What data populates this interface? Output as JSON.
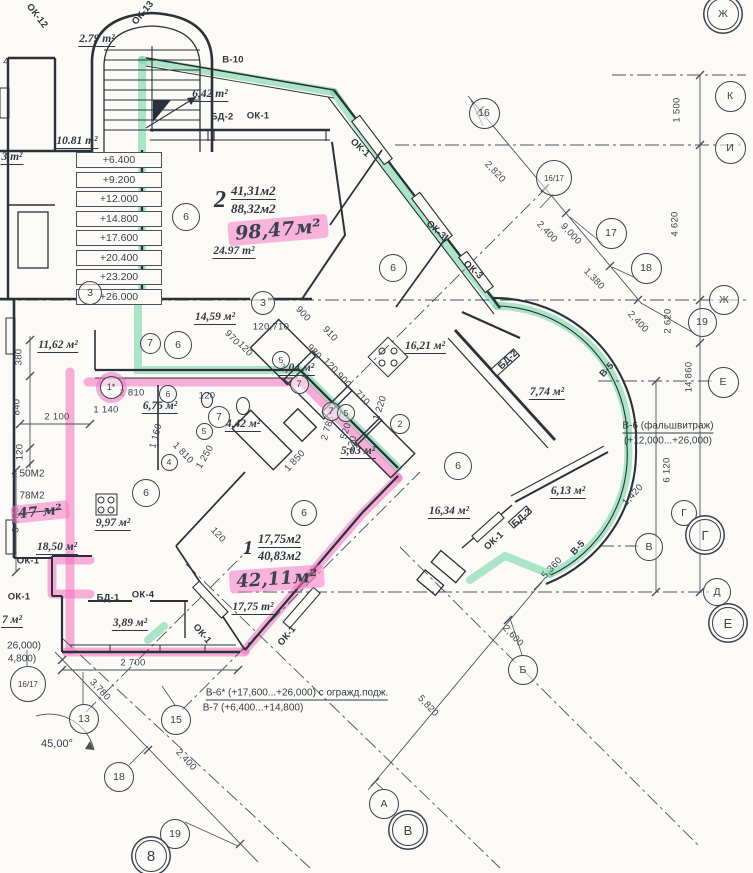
{
  "colors": {
    "paper": "#fbfaf6",
    "ink": "#39434e",
    "wall": "#2b313a",
    "highlight_green": "#7ed9aa",
    "highlight_pink": "#f478c4"
  },
  "apartments": [
    {
      "number": "2",
      "area_living": "41,31м2",
      "area_total": "88,32м2"
    },
    {
      "number": "1",
      "area_living": "17,75м2",
      "area_total": "40,83м2"
    }
  ],
  "elevations": [
    "+6.400",
    "+9.200",
    "+12.000",
    "+14.800",
    "+17.600",
    "+20.400",
    "+23.200",
    "+26.000"
  ],
  "hand_labels": [
    {
      "t": "98,47м²",
      "x": 278,
      "y": 230,
      "r": -5,
      "fs": 19
    },
    {
      "t": "42,11м²",
      "x": 277,
      "y": 579,
      "r": -4,
      "fs": 18
    },
    {
      "t": "47 м²",
      "x": 40,
      "y": 512,
      "r": -6,
      "fs": 14,
      "strike": true
    }
  ],
  "area_labels": [
    {
      "t": "2.79 m²",
      "x": 97,
      "y": 40
    },
    {
      "t": "6,42 m²",
      "x": 210,
      "y": 95
    },
    {
      "t": "10.81 m²",
      "x": 77,
      "y": 142
    },
    {
      "t": "3 m²",
      "x": 12,
      "y": 158
    },
    {
      "t": "24.97 m²",
      "x": 234,
      "y": 252
    },
    {
      "t": "14,59 м²",
      "x": 215,
      "y": 318
    },
    {
      "t": "11,62 м²",
      "x": 58,
      "y": 346
    },
    {
      "t": "16,21 м²",
      "x": 425,
      "y": 347
    },
    {
      "t": "2,04 м²",
      "x": 297,
      "y": 369
    },
    {
      "t": "6,75 м²",
      "x": 160,
      "y": 407
    },
    {
      "t": "4,42 м²",
      "x": 243,
      "y": 425
    },
    {
      "t": "5,03 м²",
      "x": 358,
      "y": 452
    },
    {
      "t": "7,74 м²",
      "x": 547,
      "y": 393
    },
    {
      "t": "16,34 м²",
      "x": 449,
      "y": 512
    },
    {
      "t": "6,13 м²",
      "x": 568,
      "y": 492
    },
    {
      "t": "9,97 м²",
      "x": 113,
      "y": 524
    },
    {
      "t": "18,50 м²",
      "x": 57,
      "y": 548
    },
    {
      "t": "17,75 m²",
      "x": 253,
      "y": 608
    },
    {
      "t": "3,89 м²",
      "x": 130,
      "y": 624
    },
    {
      "t": "7 м²",
      "x": 12,
      "y": 621
    }
  ],
  "dim_labels": [
    {
      "t": "1 500",
      "x": 677,
      "y": 110,
      "r": -90
    },
    {
      "t": "4 620",
      "x": 675,
      "y": 224,
      "r": -90
    },
    {
      "t": "2 620",
      "x": 668,
      "y": 321,
      "r": -90
    },
    {
      "t": "14 860",
      "x": 689,
      "y": 377,
      "r": -90
    },
    {
      "t": "6 120",
      "x": 667,
      "y": 470,
      "r": -90
    },
    {
      "t": "2,820",
      "x": 495,
      "y": 172,
      "r": 47
    },
    {
      "t": "2,400",
      "x": 547,
      "y": 232,
      "r": 47
    },
    {
      "t": "9,000",
      "x": 571,
      "y": 234,
      "r": 47
    },
    {
      "t": "1,380",
      "x": 594,
      "y": 279,
      "r": 47
    },
    {
      "t": "2,400",
      "x": 638,
      "y": 322,
      "r": 47
    },
    {
      "t": "1,420",
      "x": 633,
      "y": 495,
      "r": -47
    },
    {
      "t": "5,360",
      "x": 552,
      "y": 568,
      "r": -47
    },
    {
      "t": "2,600",
      "x": 513,
      "y": 636,
      "r": 47
    },
    {
      "t": "5,820",
      "x": 428,
      "y": 706,
      "r": 47
    },
    {
      "t": "2 700",
      "x": 133,
      "y": 663
    },
    {
      "t": "3,780",
      "x": 100,
      "y": 690,
      "r": 47
    },
    {
      "t": "2,400",
      "x": 186,
      "y": 760,
      "r": 47
    },
    {
      "t": "380",
      "x": 19,
      "y": 357,
      "r": -90
    },
    {
      "t": "840",
      "x": 17,
      "y": 407,
      "r": -90
    },
    {
      "t": "120",
      "x": 20,
      "y": 452,
      "r": -90
    },
    {
      "t": "2 100",
      "x": 57,
      "y": 417
    },
    {
      "t": "3 780",
      "x": 16,
      "y": 520,
      "r": -90
    },
    {
      "t": "1 140",
      "x": 106,
      "y": 410
    },
    {
      "t": "2 810",
      "x": 132,
      "y": 393
    },
    {
      "t": "120",
      "x": 207,
      "y": 396
    },
    {
      "t": "970",
      "x": 232,
      "y": 338,
      "r": 47
    },
    {
      "t": "120",
      "x": 245,
      "y": 349,
      "r": 47
    },
    {
      "t": "120,710",
      "x": 271,
      "y": 327
    },
    {
      "t": "900",
      "x": 303,
      "y": 314,
      "r": 47
    },
    {
      "t": "910",
      "x": 330,
      "y": 334,
      "r": 47
    },
    {
      "t": "980",
      "x": 314,
      "y": 352,
      "r": 47
    },
    {
      "t": "120,900",
      "x": 337,
      "y": 373,
      "r": 47
    },
    {
      "t": "710",
      "x": 362,
      "y": 398,
      "r": 47
    },
    {
      "t": "1 220",
      "x": 380,
      "y": 408,
      "r": -72
    },
    {
      "t": "1 160",
      "x": 156,
      "y": 436,
      "r": -75
    },
    {
      "t": "1 810",
      "x": 183,
      "y": 453,
      "r": 47
    },
    {
      "t": "1 250",
      "x": 205,
      "y": 457,
      "r": -60
    },
    {
      "t": "1 850",
      "x": 295,
      "y": 461,
      "r": -47
    },
    {
      "t": "2 785",
      "x": 328,
      "y": 428,
      "r": -73
    },
    {
      "t": "520",
      "x": 346,
      "y": 431,
      "r": -73
    },
    {
      "t": "120",
      "x": 352,
      "y": 444,
      "r": -73
    },
    {
      "t": "120",
      "x": 218,
      "y": 535,
      "r": 47
    }
  ],
  "tag_labels": [
    {
      "t": "ОК-12",
      "x": 37,
      "y": 16,
      "r": 52
    },
    {
      "t": "ОК-13",
      "x": 143,
      "y": 13,
      "r": -50
    },
    {
      "t": "В-10",
      "x": 233,
      "y": 60
    },
    {
      "t": "БД-2",
      "x": 222,
      "y": 117
    },
    {
      "t": "ОК-1",
      "x": 258,
      "y": 116
    },
    {
      "t": "ОК-1",
      "x": 360,
      "y": 148,
      "r": 42
    },
    {
      "t": "ОК-3",
      "x": 436,
      "y": 230,
      "r": 42
    },
    {
      "t": "ОК-3",
      "x": 473,
      "y": 270,
      "r": 42
    },
    {
      "t": "БД-2",
      "x": 508,
      "y": 360,
      "r": -45
    },
    {
      "t": "В-5",
      "x": 607,
      "y": 370,
      "r": -47
    },
    {
      "t": "В-5",
      "x": 578,
      "y": 548,
      "r": -47
    },
    {
      "t": "БД-2",
      "x": 522,
      "y": 518,
      "r": -42
    },
    {
      "t": "ОК-1",
      "x": 494,
      "y": 541,
      "r": -42
    },
    {
      "t": "ОК-1",
      "x": 202,
      "y": 634,
      "r": 50
    },
    {
      "t": "ОК-1",
      "x": 287,
      "y": 636,
      "r": -50
    },
    {
      "t": "БД-1",
      "x": 108,
      "y": 598
    },
    {
      "t": "ОК-4",
      "x": 143,
      "y": 595
    },
    {
      "t": "ОК-1",
      "x": 19,
      "y": 597
    },
    {
      "t": "ОК-1",
      "x": 28,
      "y": 561
    }
  ],
  "note_labels": [
    {
      "t": "В-6 (фальшвитраж)",
      "x": 668,
      "y": 427,
      "u": true
    },
    {
      "t": "(+12,000...+26,000)",
      "x": 668,
      "y": 441
    },
    {
      "t": "В-6* (+17,600...+26,000) с огражд.подж.",
      "x": 297,
      "y": 694,
      "u": true
    },
    {
      "t": "В-7 (+6,400...+14,800)",
      "x": 253,
      "y": 708
    },
    {
      "t": "26,000)",
      "x": 24,
      "y": 646
    },
    {
      "t": "4,800)",
      "x": 22,
      "y": 659
    },
    {
      "t": "50М2",
      "x": 32,
      "y": 474
    },
    {
      "t": "78М2",
      "x": 32,
      "y": 496
    },
    {
      "t": "4",
      "x": 6,
      "y": 62
    },
    {
      "t": "45,00°",
      "x": 57,
      "y": 744,
      "deg": true
    }
  ],
  "bubbles": [
    {
      "t": "Ж",
      "x": 722,
      "y": 13,
      "s": 30,
      "d": true
    },
    {
      "t": "К",
      "x": 729,
      "y": 95,
      "s": 29
    },
    {
      "t": "И",
      "x": 729,
      "y": 147,
      "s": 29
    },
    {
      "t": "16",
      "x": 483,
      "y": 112,
      "s": 29
    },
    {
      "t": "16/17",
      "x": 553,
      "y": 177,
      "s": 34,
      "fs": 8
    },
    {
      "t": "17",
      "x": 610,
      "y": 232,
      "s": 29
    },
    {
      "t": "18",
      "x": 645,
      "y": 267,
      "s": 29
    },
    {
      "t": "Ж",
      "x": 723,
      "y": 299,
      "s": 28
    },
    {
      "t": "19",
      "x": 701,
      "y": 321,
      "s": 27
    },
    {
      "t": "Е",
      "x": 722,
      "y": 381,
      "s": 29
    },
    {
      "t": "Г",
      "x": 683,
      "y": 512,
      "s": 24
    },
    {
      "t": "Г",
      "x": 704,
      "y": 534,
      "s": 30,
      "d": true,
      "fs": 13
    },
    {
      "t": "В",
      "x": 648,
      "y": 546,
      "s": 26
    },
    {
      "t": "Д",
      "x": 716,
      "y": 591,
      "s": 26
    },
    {
      "t": "Е",
      "x": 727,
      "y": 622,
      "s": 30,
      "d": true,
      "fs": 13
    },
    {
      "t": "Б",
      "x": 522,
      "y": 669,
      "s": 28
    },
    {
      "t": "А",
      "x": 383,
      "y": 803,
      "s": 28
    },
    {
      "t": "В",
      "x": 407,
      "y": 829,
      "s": 30,
      "d": true,
      "fs": 13
    },
    {
      "t": "13",
      "x": 83,
      "y": 718,
      "s": 28
    },
    {
      "t": "15",
      "x": 175,
      "y": 719,
      "s": 28
    },
    {
      "t": "18",
      "x": 118,
      "y": 776,
      "s": 28
    },
    {
      "t": "19",
      "x": 174,
      "y": 833,
      "s": 28
    },
    {
      "t": "8",
      "x": 150,
      "y": 855,
      "s": 30,
      "d": true,
      "fs": 15
    },
    {
      "t": "16/17",
      "x": 27,
      "y": 683,
      "s": 34,
      "fs": 8
    },
    {
      "t": "3",
      "x": 89,
      "y": 292,
      "s": 22
    },
    {
      "t": "3",
      "x": 262,
      "y": 302,
      "s": 22
    },
    {
      "t": "7",
      "x": 149,
      "y": 342,
      "s": 19
    },
    {
      "t": "6",
      "x": 177,
      "y": 344,
      "s": 26
    },
    {
      "t": "6",
      "x": 185,
      "y": 216,
      "s": 26
    },
    {
      "t": "6",
      "x": 392,
      "y": 267,
      "s": 26
    },
    {
      "t": "6",
      "x": 457,
      "y": 465,
      "s": 26
    },
    {
      "t": "6",
      "x": 303,
      "y": 512,
      "s": 24
    },
    {
      "t": "6",
      "x": 145,
      "y": 492,
      "s": 26
    },
    {
      "t": "1*",
      "x": 110,
      "y": 386,
      "s": 21,
      "fs": 9,
      "pink": true
    },
    {
      "t": "6",
      "x": 167,
      "y": 393,
      "s": 16,
      "fs": 8.5
    },
    {
      "t": "5",
      "x": 280,
      "y": 359,
      "s": 16,
      "fs": 8.5
    },
    {
      "t": "7",
      "x": 298,
      "y": 383,
      "s": 17,
      "fs": 9
    },
    {
      "t": "7",
      "x": 330,
      "y": 410,
      "s": 17,
      "fs": 9
    },
    {
      "t": "5",
      "x": 345,
      "y": 412,
      "s": 16,
      "fs": 8.5
    },
    {
      "t": "2",
      "x": 399,
      "y": 423,
      "s": 18,
      "fs": 9
    },
    {
      "t": "7",
      "x": 218,
      "y": 416,
      "s": 20,
      "fs": 10
    },
    {
      "t": "5",
      "x": 203,
      "y": 430,
      "s": 15,
      "fs": 8.5
    },
    {
      "t": "4",
      "x": 168,
      "y": 461,
      "s": 15,
      "fs": 8.5
    }
  ]
}
